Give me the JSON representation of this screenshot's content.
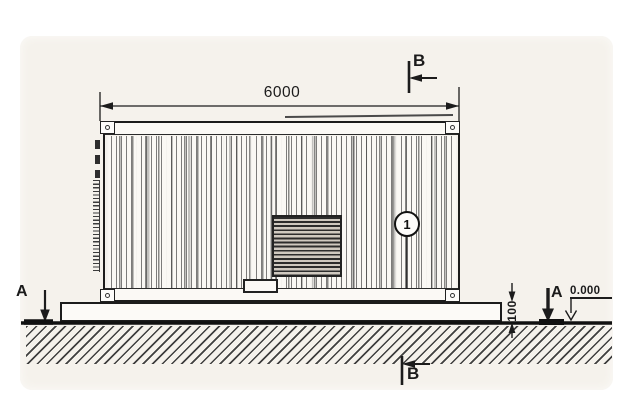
{
  "drawing": {
    "labels": {
      "length_dimension": "6000",
      "height_dimension": "100",
      "level_mark": "0.000",
      "section_a": "A",
      "section_b": "B",
      "callout_1": "1"
    },
    "colors": {
      "background": "#ffffff",
      "paper": "#f5f2ec",
      "line": "#1c1c1c",
      "hatch_line": "#3f3f3f",
      "louver_dark": "#2c2c2c"
    }
  }
}
